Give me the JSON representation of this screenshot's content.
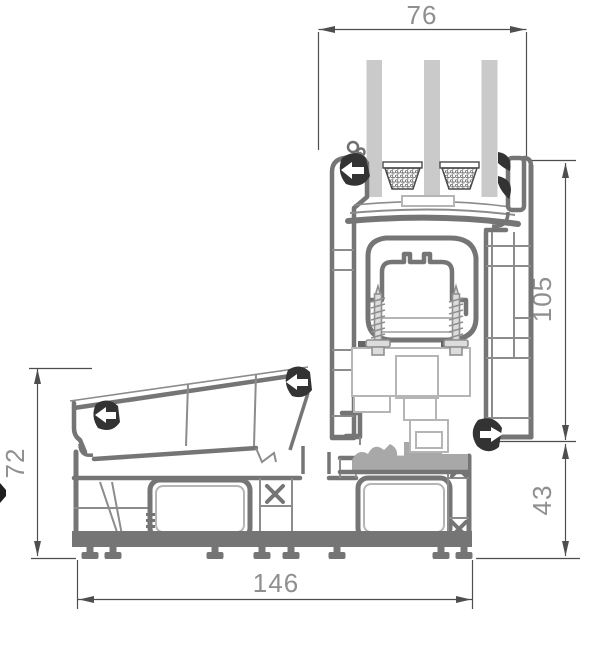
{
  "diagram": {
    "type": "window-threshold-profile-cross-section",
    "dimensions": {
      "top": "76",
      "right_upper": "105",
      "right_lower": "43",
      "left": "72",
      "bottom": "146"
    },
    "colors": {
      "background": "#ffffff",
      "profile_stroke": "#757575",
      "profile_thin": "#8c8c8c",
      "glass_fill": "#cacaca",
      "gasket": "#333333",
      "hardware": "#b5b5b5",
      "dim_line": "#4e4e4e",
      "dim_text": "#8f8f8f"
    }
  }
}
